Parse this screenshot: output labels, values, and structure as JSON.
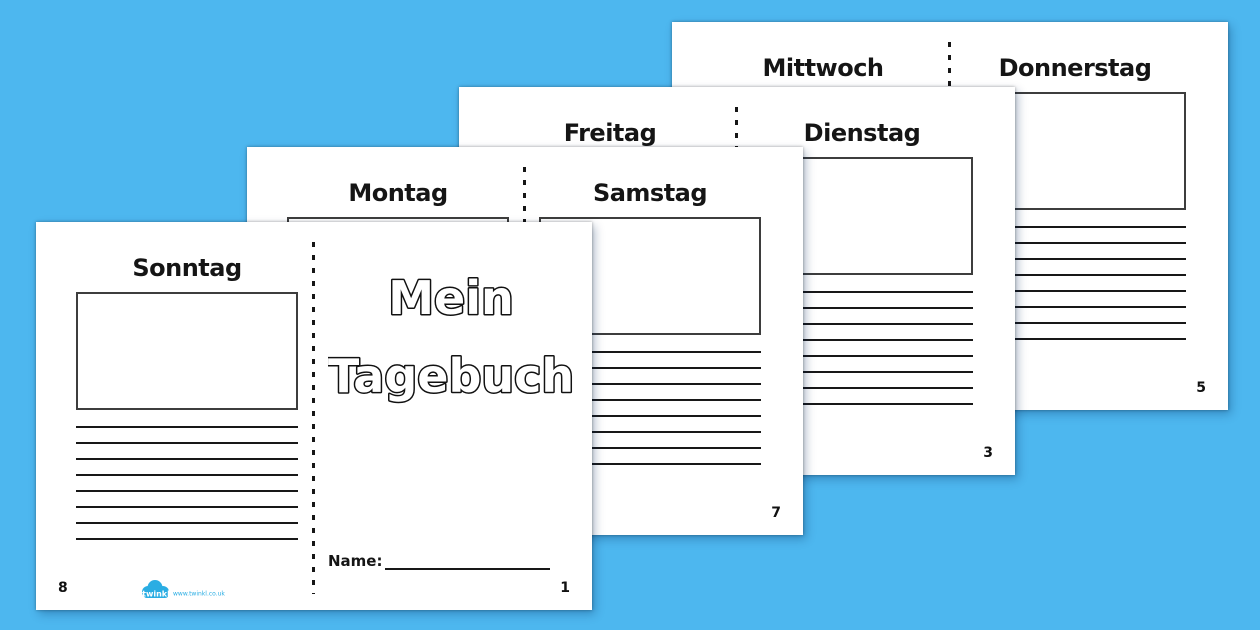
{
  "document_title": "Mein Tagebuch foldable diary booklet printable",
  "colors": {
    "background": "#4db7ef",
    "paper": "#ffffff",
    "ink": "#181818",
    "box_border": "#3d3d3d",
    "logo_blue": "#2aade3"
  },
  "layout": {
    "lines_per_section": 8
  },
  "pages": [
    {
      "name": "sheet-mittwoch-donnerstag",
      "left_day": "Mittwoch",
      "right_day": "Donnerstag",
      "right_page_number": "5"
    },
    {
      "name": "sheet-freitag-dienstag",
      "left_day": "Freitag",
      "right_day": "Dienstag",
      "right_page_number": "3"
    },
    {
      "name": "sheet-montag-samstag",
      "left_day": "Montag",
      "right_day": "Samstag",
      "right_page_number": "7"
    },
    {
      "name": "sheet-cover-sonntag",
      "left_day": "Sonntag",
      "left_page_number": "8",
      "cover": {
        "title_line1": "Mein",
        "title_line2": "Tagebuch",
        "name_label": "Name:",
        "page_number": "1"
      },
      "logo": {
        "brand": "twinkl",
        "url_label": "www.twinkl.co.uk"
      }
    }
  ]
}
